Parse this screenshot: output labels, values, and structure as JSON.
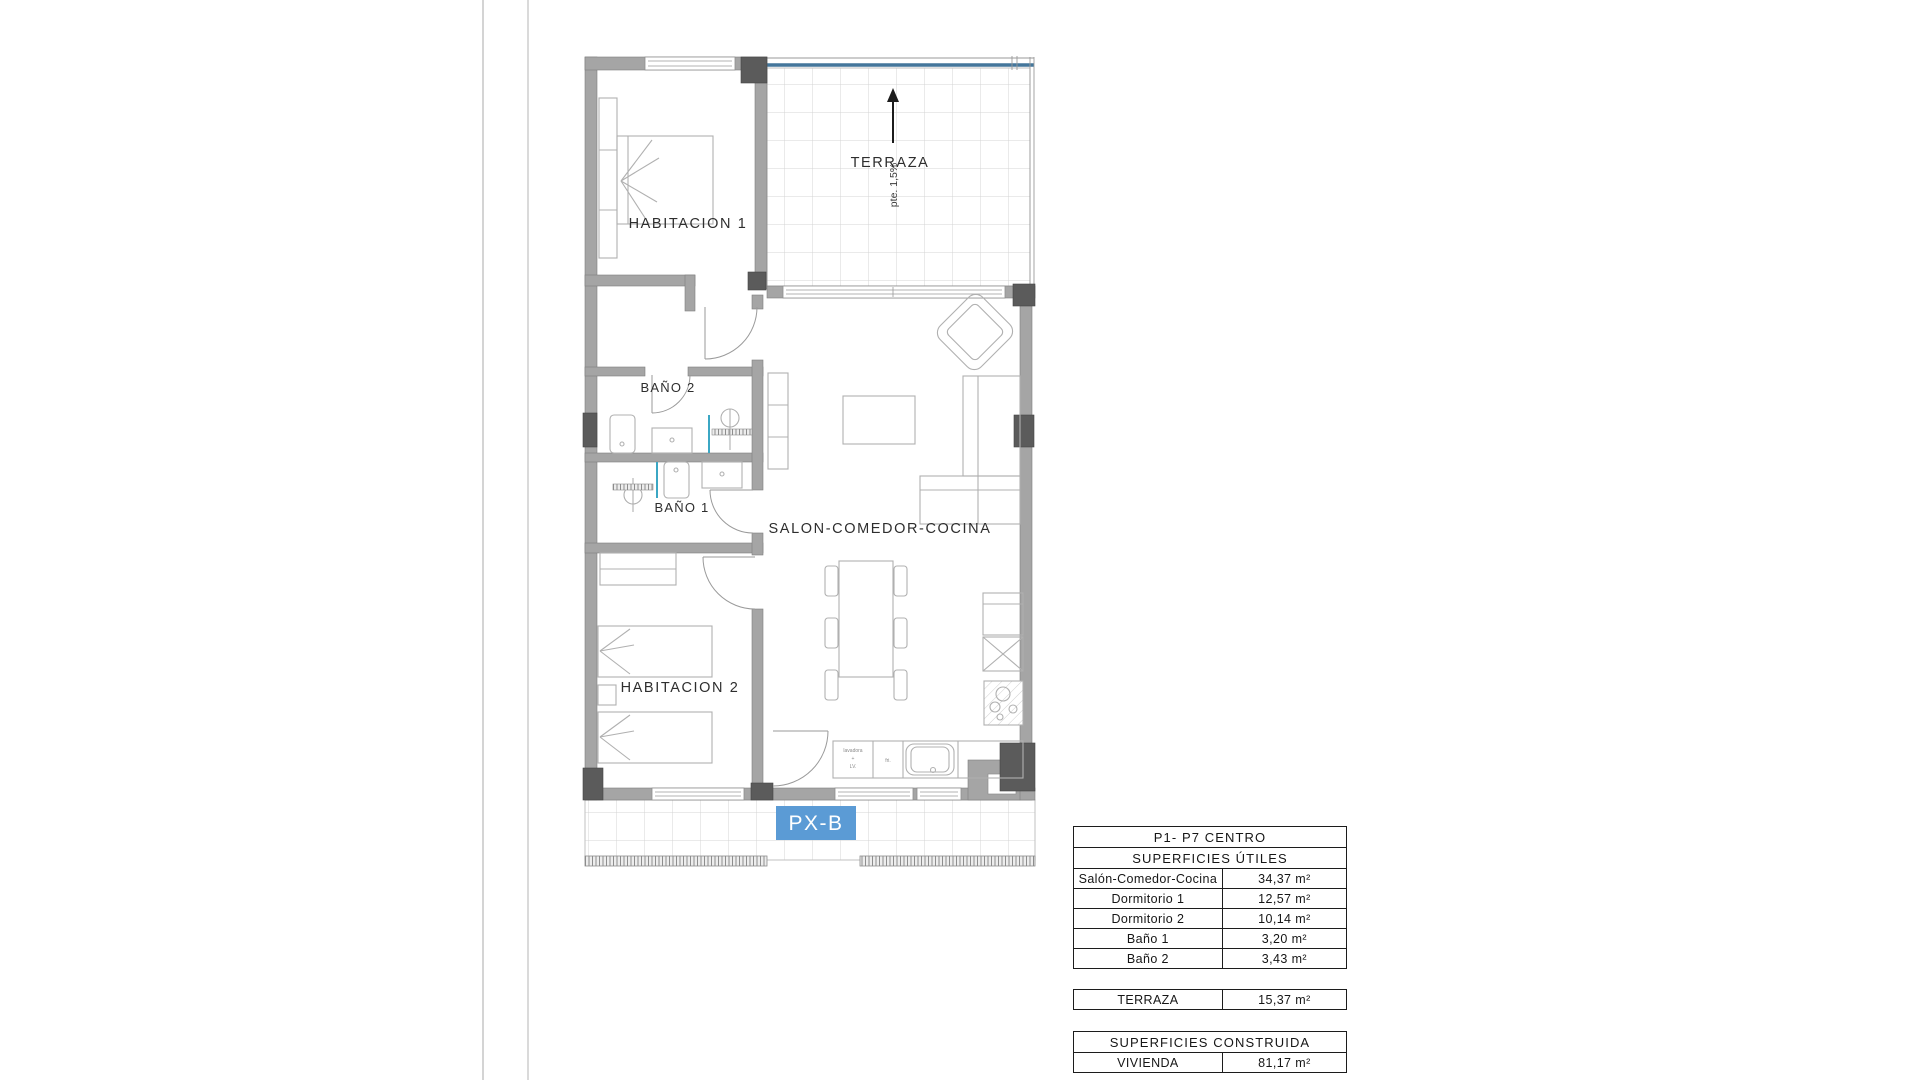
{
  "plan": {
    "badge": "PX-B",
    "slope_label": "pte. 1,5%",
    "rooms": {
      "terraza": "TERRAZA",
      "habitacion1": "HABITACION 1",
      "habitacion2": "HABITACION 2",
      "bano1": "BAÑO 1",
      "bano2": "BAÑO 2",
      "salon": "SALON-COMEDOR-COCINA"
    },
    "kitchen": {
      "washer_line1": "lavadora",
      "washer_line2": "+",
      "washer_line3": "LV.",
      "appliance": "fri."
    },
    "colors": {
      "wall": "#a5a5a5",
      "pillar": "#5b5b5b",
      "balustrade": "#44769b",
      "badge_bg": "#5b9bd5",
      "furniture_line": "#b0b0b0",
      "tile_line": "#d4d4d4"
    }
  },
  "tables": {
    "unit": {
      "title": "P1- P7 CENTRO",
      "subtitle": "SUPERFICIES ÚTILES",
      "rows": [
        {
          "label": "Salón-Comedor-Cocina",
          "value": "34,37 m²"
        },
        {
          "label": "Dormitorio 1",
          "value": "12,57 m²"
        },
        {
          "label": "Dormitorio 2",
          "value": "10,14 m²"
        },
        {
          "label": "Baño 1",
          "value": "3,20 m²"
        },
        {
          "label": "Baño 2",
          "value": "3,43 m²"
        }
      ]
    },
    "terraza": {
      "label": "TERRAZA",
      "value": "15,37 m²"
    },
    "construida": {
      "title": "SUPERFICIES CONSTRUIDA",
      "rows": [
        {
          "label": "VIVIENDA",
          "value": "81,17 m²"
        }
      ]
    }
  }
}
